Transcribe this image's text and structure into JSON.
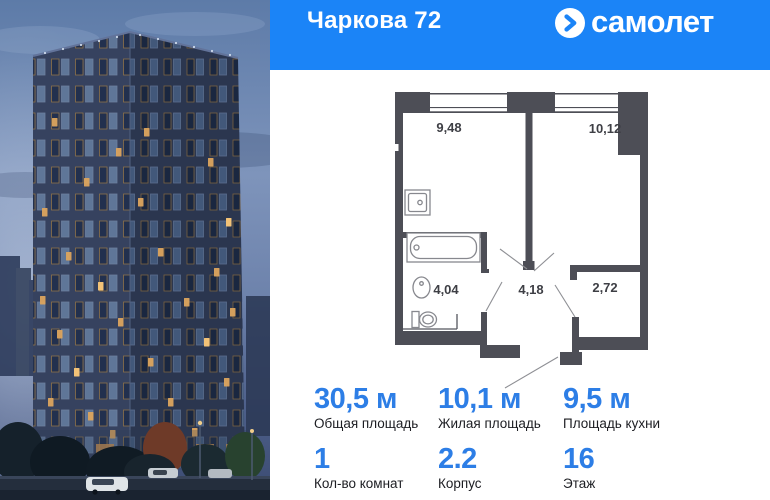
{
  "header": {
    "title": "Чаркова 72",
    "logo_text": "самолет"
  },
  "colors": {
    "brand_blue": "#1b84f7",
    "stat_number_blue": "#2d7ee6",
    "plan_wall": "#4d4e56",
    "label_dark": "#1c1d22"
  },
  "floor_plan": {
    "rooms": [
      {
        "name": "kitchen-living",
        "area": "9,48"
      },
      {
        "name": "bedroom",
        "area": "10,12"
      },
      {
        "name": "bathroom",
        "area": "4,04"
      },
      {
        "name": "hallway",
        "area": "4,18"
      },
      {
        "name": "wardrobe",
        "area": "2,72"
      }
    ]
  },
  "stats": [
    {
      "value": "30,5 м",
      "label": "Общая площадь"
    },
    {
      "value": "10,1 м",
      "label": "Жилая площадь"
    },
    {
      "value": "9,5 м",
      "label": "Площадь кухни"
    },
    {
      "value": "1",
      "label": "Кол-во комнат"
    },
    {
      "value": "2.2",
      "label": "Корпус"
    },
    {
      "value": "16",
      "label": "Этаж"
    }
  ]
}
